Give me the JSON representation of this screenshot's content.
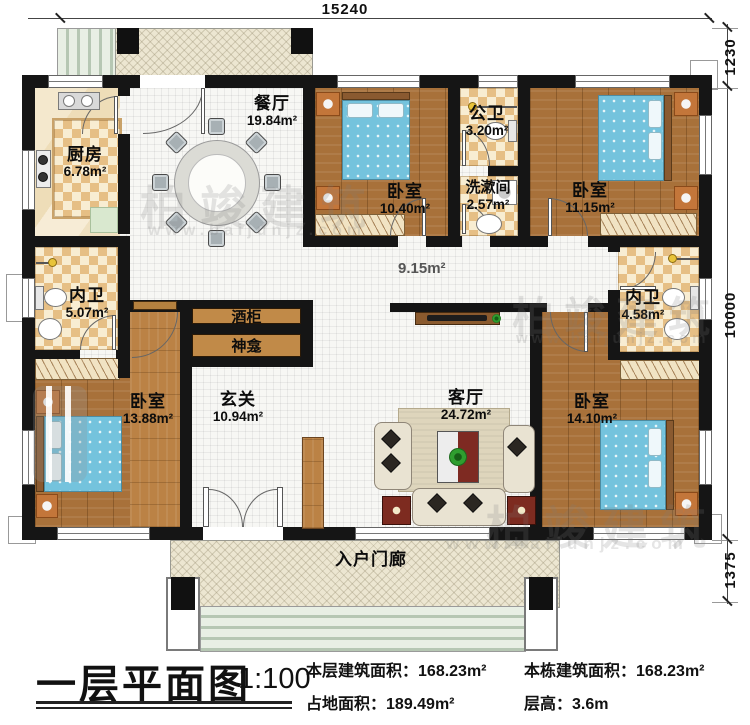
{
  "dimensions": {
    "top": "15240",
    "right_top": "1230",
    "right_mid": "10000",
    "right_bottom": "1375"
  },
  "rooms": {
    "kitchen": {
      "name": "厨房",
      "area": "6.78m²"
    },
    "dining": {
      "name": "餐厅",
      "area": "19.84m²"
    },
    "bedroom_top_mid": {
      "name": "卧室",
      "area": "10.40m²"
    },
    "public_bath": {
      "name": "公卫",
      "area": "3.20m²"
    },
    "washroom": {
      "name": "洗漱间",
      "area": "2.57m²"
    },
    "bedroom_top_right": {
      "name": "卧室",
      "area": "11.15m²"
    },
    "ensuite_left": {
      "name": "内卫",
      "area": "5.07m²"
    },
    "ensuite_right": {
      "name": "内卫",
      "area": "4.58m²"
    },
    "bedroom_left": {
      "name": "卧室",
      "area": "13.88m²"
    },
    "foyer": {
      "name": "玄关",
      "area": "10.94m²"
    },
    "living": {
      "name": "客厅",
      "area": "24.72m²"
    },
    "bedroom_right": {
      "name": "卧室",
      "area": "14.10m²"
    },
    "corridor": {
      "area": "9.15m²"
    },
    "porch": {
      "name": "入户门廊"
    }
  },
  "cabinets": {
    "wine": "酒柜",
    "shrine": "神龛"
  },
  "titleblock": {
    "title": "一层平面图",
    "scale": "1:100",
    "stats": [
      {
        "label": "本层建筑面积：",
        "value": "168.23m²"
      },
      {
        "label": "占地面积：",
        "value": "189.49m²"
      },
      {
        "label": "本栋建筑面积：",
        "value": "168.23m²"
      },
      {
        "label": "层高：",
        "value": "3.6m"
      }
    ]
  },
  "watermark": {
    "brand": "柏竣建筑",
    "url": "www.baijunjz.com"
  }
}
